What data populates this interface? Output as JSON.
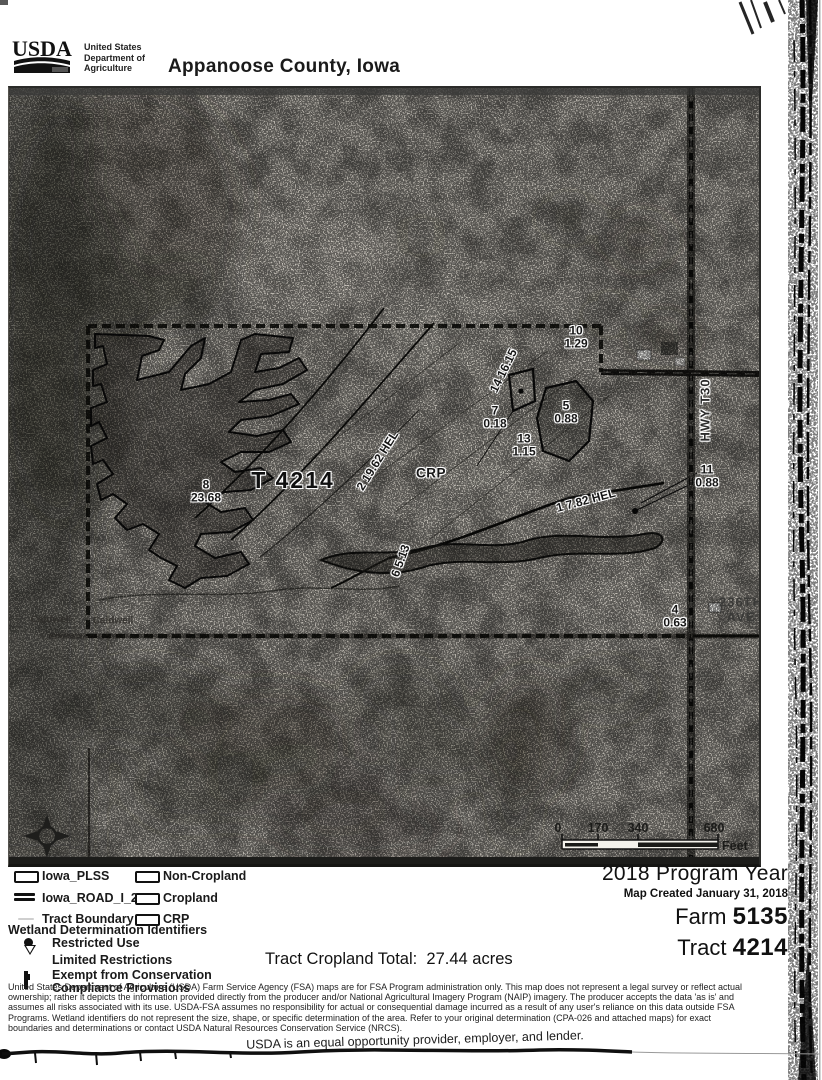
{
  "header": {
    "logo_text": "USDA",
    "dept_line1": "United States",
    "dept_line2": "Department of",
    "dept_line3": "Agriculture",
    "title": "Appanoose County, Iowa"
  },
  "map": {
    "tract_label": "T 4214",
    "crp_label": "CRP",
    "labels": {
      "hwy": "HWY T30",
      "ave1": "236TH",
      "ave2": "AVE",
      "caldwell_a": "Caldwell",
      "caldwell_b": "Caldwell",
      "strip2": "2 19.62 HEL",
      "strip1": "1 7.82 HEL",
      "strip6": "6 5.13",
      "strip14": "14  16.15"
    },
    "fields": [
      {
        "num": "8",
        "acres": "23.68"
      },
      {
        "num": "10",
        "acres": "1.29"
      },
      {
        "num": "7",
        "acres": "0.18"
      },
      {
        "num": "13",
        "acres": "1.15"
      },
      {
        "num": "5",
        "acres": "0.88"
      },
      {
        "num": "11",
        "acres": "0.88"
      },
      {
        "num": "4",
        "acres": "0.63"
      }
    ],
    "scale": {
      "t0": "0",
      "t1": "170",
      "t2": "340",
      "t3": "680",
      "unit": "Feet"
    }
  },
  "legend": {
    "left_items": [
      {
        "icon": "plss-swatch",
        "label": "Iowa_PLSS"
      },
      {
        "icon": "road-swatch",
        "label": "Iowa_ROAD_I_2008"
      },
      {
        "icon": "tract-boundary-swatch",
        "label": "Tract Boundary"
      }
    ],
    "right_items": [
      {
        "icon": "noncropland-swatch",
        "label": "Non-Cropland"
      },
      {
        "icon": "cropland-swatch",
        "label": "Cropland"
      },
      {
        "icon": "crp-swatch",
        "label": "CRP"
      }
    ],
    "wetland_heading": "Wetland Determination Identifiers",
    "wetland_items": [
      {
        "label": "Restricted Use"
      },
      {
        "label": "Limited Restrictions"
      },
      {
        "label_line1": "Exempt from Conservation",
        "label_line2": "Compliance Provisions"
      }
    ]
  },
  "info": {
    "program_year": "2018 Program Year",
    "map_created": "Map Created January 31, 2018",
    "farm_label": "Farm",
    "farm_number": "5135",
    "tract_label": "Tract",
    "tract_number": "4214",
    "cropland_total_label": "Tract Cropland Total:",
    "cropland_total_value": "27.44 acres"
  },
  "disclaimer": {
    "lines": [
      "United States Department of Agriculture (USDA) Farm Service Agency (FSA) maps are for FSA Program administration only.  This map does not represent a legal survey or reflect actual",
      "ownership; rather it depicts the information provided directly from the producer and/or National Agricultural Imagery Program (NAIP) imagery.  The producer accepts the data 'as is' and",
      "assumes all risks associated with its use.  USDA-FSA assumes no responsibility for actual or consequential damage incurred as a result of any user's reliance on this data outside FSA",
      "Programs.  Wetland identifiers do not represent the size, shape, or specific determination of the area.  Refer to your original determination (CPA-026 and attached maps) for exact",
      "boundaries and determinations or contact USDA Natural Resources Conservation Service (NRCS)."
    ],
    "eo_statement": "USDA is an equal opportunity provider, employer, and lender."
  },
  "colors": {
    "paper": "#ffffff",
    "ink": "#111111",
    "photo_gray": "#b7b3ab"
  }
}
